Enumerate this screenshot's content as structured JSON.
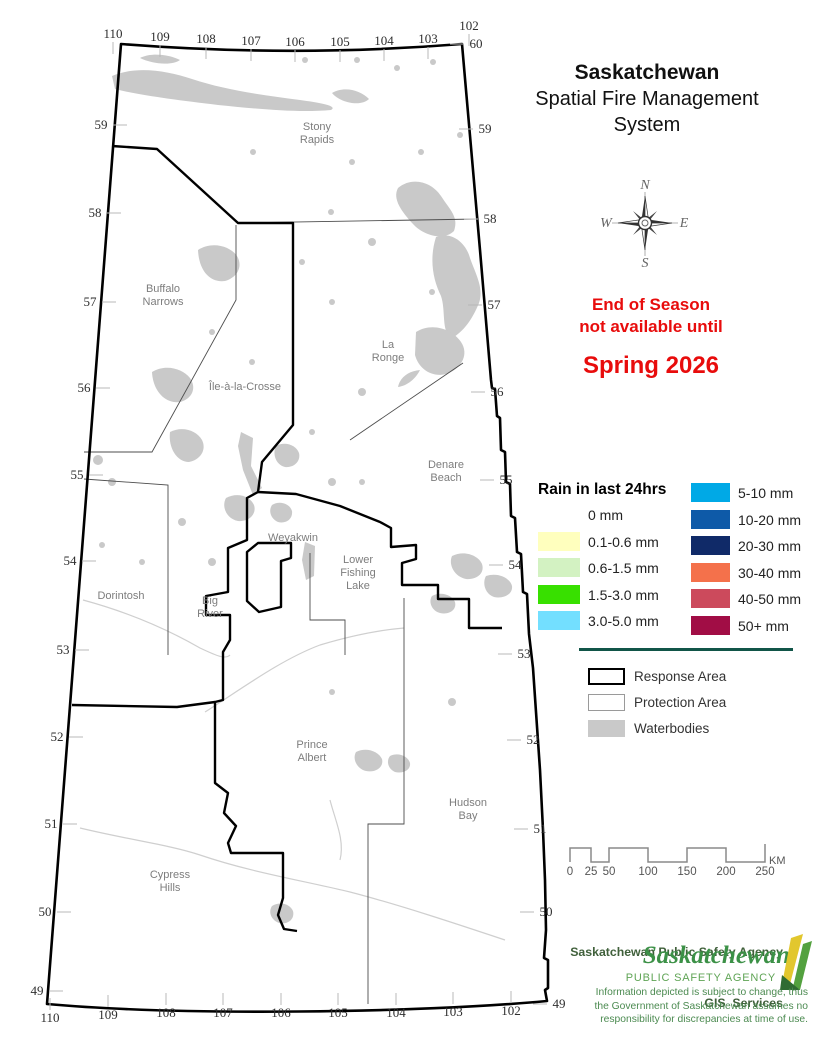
{
  "title": {
    "line1": "Saskatchewan",
    "line2": "Spatial Fire Management",
    "line3": "System"
  },
  "notice": {
    "line1": "End of Season",
    "line2": "not available until",
    "line3": "Spring 2026"
  },
  "compass": {
    "n": "N",
    "e": "E",
    "s": "S",
    "w": "W"
  },
  "colors": {
    "notice_red": "#e80c0c",
    "divider_green": "#115548",
    "logo_green": "#3c9147",
    "logo_caps_green": "#5fa455",
    "credit_green": "#40603b",
    "disclaimer_green": "#4b8a50",
    "waterbody_gray": "#c9c9c9"
  },
  "rain_legend": {
    "title": "Rain in last 24hrs",
    "left": [
      {
        "label": "0 mm",
        "color": "#ffffff"
      },
      {
        "label": "0.1-0.6 mm",
        "color": "#ffffbe"
      },
      {
        "label": "0.6-1.5 mm",
        "color": "#d3f2c2"
      },
      {
        "label": "1.5-3.0 mm",
        "color": "#38e000"
      },
      {
        "label": "3.0-5.0 mm",
        "color": "#73dfff"
      }
    ],
    "right": [
      {
        "label": "5-10 mm",
        "color": "#00a9e6"
      },
      {
        "label": "10-20 mm",
        "color": "#0e5aa8"
      },
      {
        "label": "20-30 mm",
        "color": "#102a68"
      },
      {
        "label": "30-40 mm",
        "color": "#f4714b"
      },
      {
        "label": "40-50 mm",
        "color": "#cc4a5c"
      },
      {
        "label": "50+ mm",
        "color": "#a10d45"
      }
    ]
  },
  "area_legend": {
    "items": [
      {
        "label": "Response Area",
        "swatch": "response"
      },
      {
        "label": "Protection Area",
        "swatch": "protection"
      },
      {
        "label": "Waterbodies",
        "swatch": "waterbody"
      }
    ]
  },
  "scalebar": {
    "labels": [
      "0",
      "25",
      "50",
      "100",
      "150",
      "200",
      "250"
    ],
    "unit": "KM"
  },
  "credits": {
    "agency_line1": "Saskatchewan Public Safety Agency",
    "agency_line2": "GIS  Services",
    "logo_line1": "Saskatchewan",
    "logo_line2": "PUBLIC SAFETY AGENCY",
    "disclaimer_lines": [
      "Information depicted is subject to change, thus",
      "the Government of Saskatchewan assumes no",
      "responsibility for discrepancies at time of use."
    ]
  },
  "map": {
    "places": [
      {
        "lines": [
          "Stony",
          "Rapids"
        ],
        "x": 317,
        "y": 130
      },
      {
        "lines": [
          "Buffalo",
          "Narrows"
        ],
        "x": 163,
        "y": 292
      },
      {
        "lines": [
          "Île-à-la-Crosse"
        ],
        "x": 245,
        "y": 390
      },
      {
        "lines": [
          "La",
          "Ronge"
        ],
        "x": 388,
        "y": 348
      },
      {
        "lines": [
          "Denare",
          "Beach"
        ],
        "x": 446,
        "y": 468
      },
      {
        "lines": [
          "Weyakwin"
        ],
        "x": 293,
        "y": 541
      },
      {
        "lines": [
          "Lower",
          "Fishing",
          "Lake"
        ],
        "x": 358,
        "y": 563
      },
      {
        "lines": [
          "Dorintosh"
        ],
        "x": 121,
        "y": 599
      },
      {
        "lines": [
          "Big",
          "River"
        ],
        "x": 210,
        "y": 604
      },
      {
        "lines": [
          "Prince",
          "Albert"
        ],
        "x": 312,
        "y": 748
      },
      {
        "lines": [
          "Hudson",
          "Bay"
        ],
        "x": 468,
        "y": 806
      },
      {
        "lines": [
          "Cypress",
          "Hills"
        ],
        "x": 170,
        "y": 878
      }
    ],
    "grid_labels": [
      {
        "t": "110",
        "x": 113,
        "y": 38,
        "side": "top"
      },
      {
        "t": "109",
        "x": 160,
        "y": 41,
        "side": "top"
      },
      {
        "t": "108",
        "x": 206,
        "y": 43,
        "side": "top"
      },
      {
        "t": "107",
        "x": 251,
        "y": 45,
        "side": "top"
      },
      {
        "t": "106",
        "x": 295,
        "y": 46,
        "side": "top"
      },
      {
        "t": "105",
        "x": 340,
        "y": 46,
        "side": "top"
      },
      {
        "t": "104",
        "x": 384,
        "y": 45,
        "side": "top"
      },
      {
        "t": "103",
        "x": 428,
        "y": 43,
        "side": "top"
      },
      {
        "t": "102",
        "x": 469,
        "y": 30,
        "side": "top"
      },
      {
        "t": "60",
        "x": 476,
        "y": 48,
        "side": "right"
      },
      {
        "t": "59",
        "x": 101,
        "y": 129,
        "side": "left"
      },
      {
        "t": "58",
        "x": 95,
        "y": 217,
        "side": "left"
      },
      {
        "t": "57",
        "x": 90,
        "y": 306,
        "side": "left"
      },
      {
        "t": "56",
        "x": 84,
        "y": 392,
        "side": "left"
      },
      {
        "t": "55",
        "x": 77,
        "y": 479,
        "side": "left"
      },
      {
        "t": "54",
        "x": 70,
        "y": 565,
        "side": "left"
      },
      {
        "t": "53",
        "x": 63,
        "y": 654,
        "side": "left"
      },
      {
        "t": "52",
        "x": 57,
        "y": 741,
        "side": "left"
      },
      {
        "t": "51",
        "x": 51,
        "y": 828,
        "side": "left"
      },
      {
        "t": "50",
        "x": 45,
        "y": 916,
        "side": "left"
      },
      {
        "t": "49",
        "x": 37,
        "y": 995,
        "side": "left"
      },
      {
        "t": "59",
        "x": 485,
        "y": 133,
        "side": "right"
      },
      {
        "t": "58",
        "x": 490,
        "y": 223,
        "side": "right"
      },
      {
        "t": "57",
        "x": 494,
        "y": 309,
        "side": "right"
      },
      {
        "t": "56",
        "x": 497,
        "y": 396,
        "side": "right"
      },
      {
        "t": "55",
        "x": 506,
        "y": 484,
        "side": "right"
      },
      {
        "t": "54",
        "x": 515,
        "y": 569,
        "side": "right"
      },
      {
        "t": "53",
        "x": 524,
        "y": 658,
        "side": "right"
      },
      {
        "t": "52",
        "x": 533,
        "y": 744,
        "side": "right"
      },
      {
        "t": "51",
        "x": 540,
        "y": 833,
        "side": "right"
      },
      {
        "t": "50",
        "x": 546,
        "y": 916,
        "side": "right"
      },
      {
        "t": "49",
        "x": 559,
        "y": 1008,
        "side": "right"
      },
      {
        "t": "110",
        "x": 50,
        "y": 1022,
        "side": "bottom"
      },
      {
        "t": "109",
        "x": 108,
        "y": 1019,
        "side": "bottom"
      },
      {
        "t": "108",
        "x": 166,
        "y": 1017,
        "side": "bottom"
      },
      {
        "t": "107",
        "x": 223,
        "y": 1017,
        "side": "bottom"
      },
      {
        "t": "106",
        "x": 281,
        "y": 1017,
        "side": "bottom"
      },
      {
        "t": "105",
        "x": 338,
        "y": 1017,
        "side": "bottom"
      },
      {
        "t": "104",
        "x": 396,
        "y": 1017,
        "side": "bottom"
      },
      {
        "t": "103",
        "x": 453,
        "y": 1016,
        "side": "bottom"
      },
      {
        "t": "102",
        "x": 511,
        "y": 1015,
        "side": "bottom"
      }
    ]
  }
}
